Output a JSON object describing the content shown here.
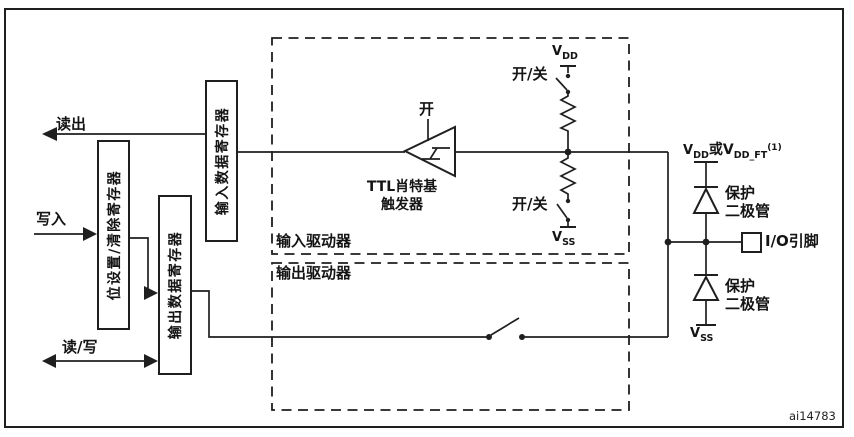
{
  "figure": {
    "id": "ai14783"
  },
  "colors": {
    "line": "#1f1f1f",
    "background": "#ffffff"
  },
  "labels": {
    "read_out": "读出",
    "write_in": "写入",
    "read_write": "读/写",
    "reg_input_data": "输入数据寄存器",
    "reg_bit_set_reset": "位设置/清除寄存器",
    "reg_output_data": "输出数据寄存器",
    "input_driver": "输入驱动器",
    "output_driver": "输出驱动器",
    "trigger_enable": "开",
    "schmitt_line1": "TTL肖特基",
    "schmitt_line2": "触发器",
    "pullup_switch": "开/关",
    "pulldown_switch": "开/关",
    "protect_upper_line1": "保护",
    "protect_upper_line2": "二极管",
    "protect_lower_line1": "保护",
    "protect_lower_line2": "二极管",
    "io_pin": "I/O引脚"
  },
  "power": {
    "v": "V",
    "dd": "DD",
    "ss": "SS",
    "or_v": "或V",
    "dd_ft": "DD_FT",
    "note_sup": "(1)"
  }
}
